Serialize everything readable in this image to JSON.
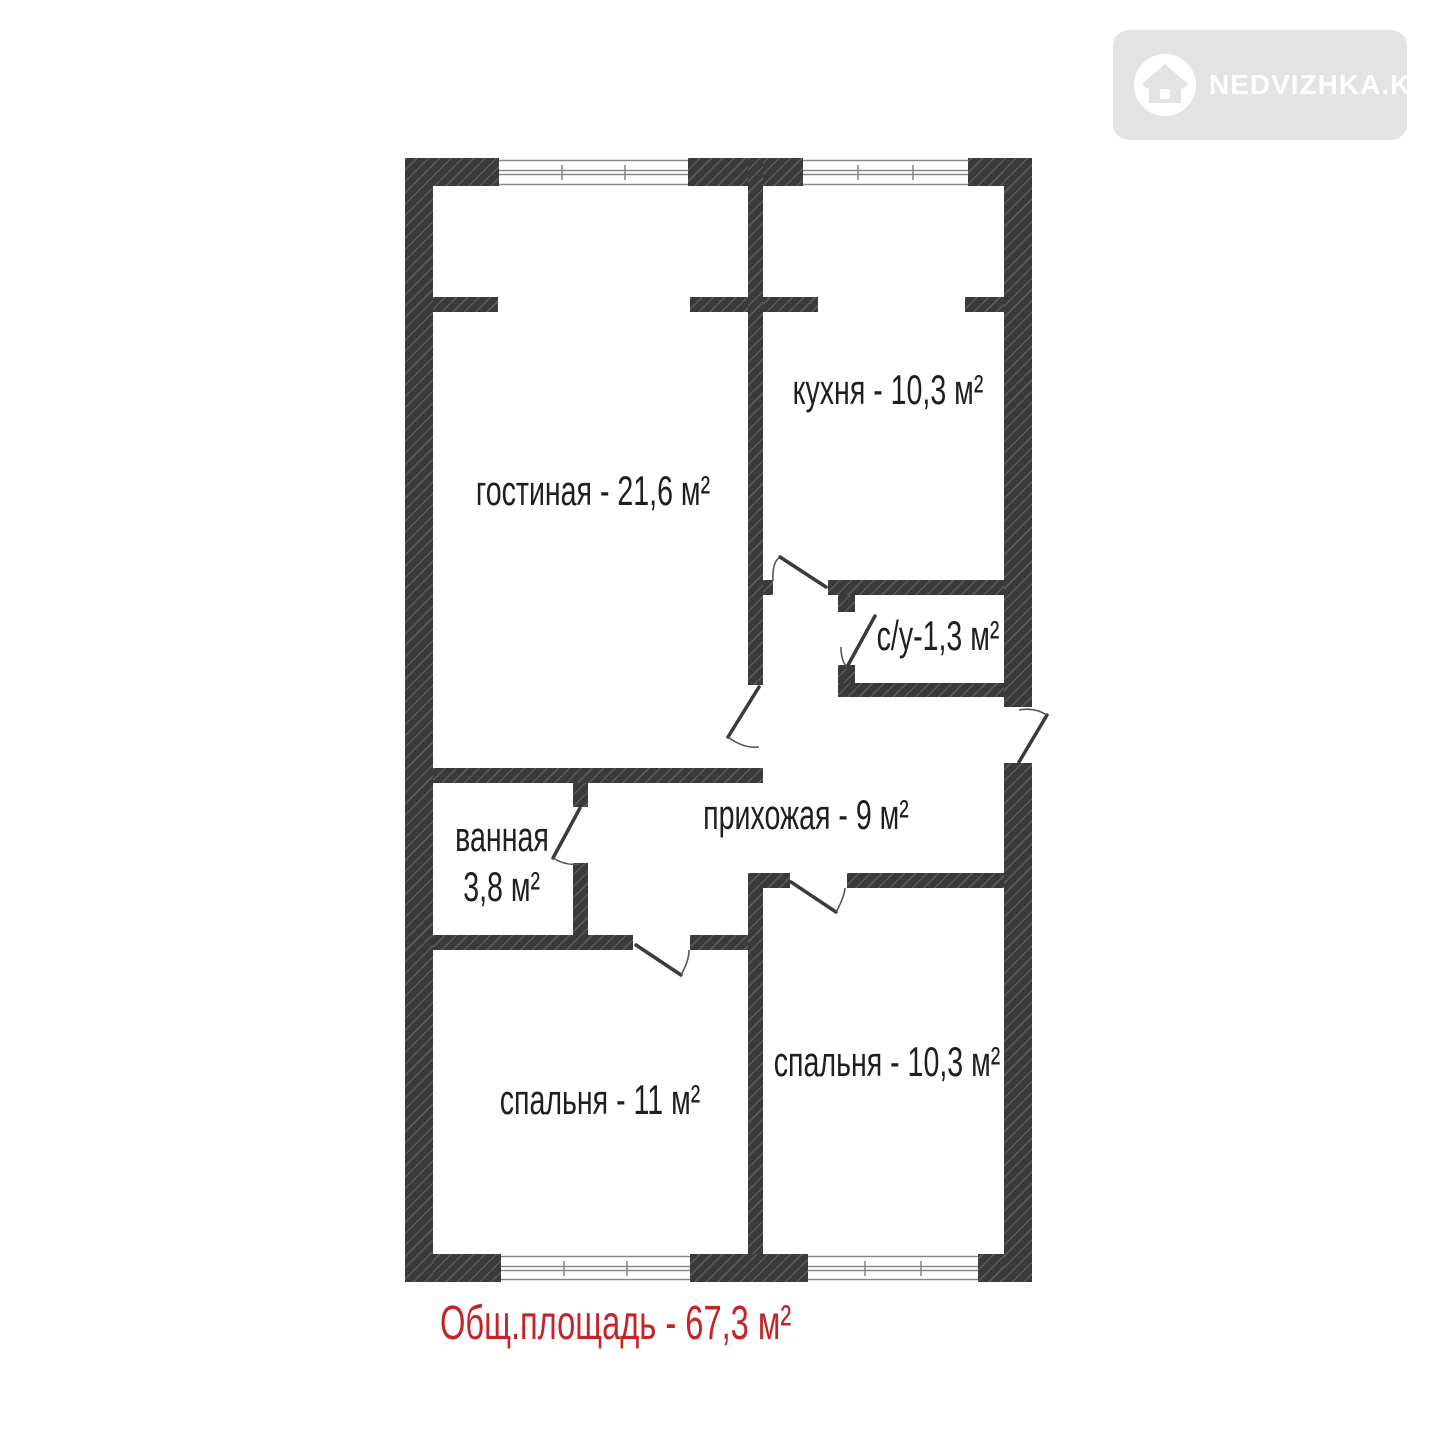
{
  "watermark": {
    "brand": "NEDVIZHKA.KZ",
    "icon": "house-icon"
  },
  "floor_plan": {
    "rooms": {
      "living_room": {
        "label": "гостиная - 21,6 м²"
      },
      "kitchen": {
        "label": "кухня - 10,3 м²"
      },
      "toilet": {
        "label": "с/у-1,3 м²"
      },
      "hallway": {
        "label": "прихожая - 9 м²"
      },
      "bathroom": {
        "name": "ванная",
        "area": "3,8 м²"
      },
      "bedroom_1": {
        "label": "спальня - 11 м²"
      },
      "bedroom_2": {
        "label": "спальня - 10,3 м²"
      }
    },
    "total_area": {
      "label": "Общ.площадь - 67,3 м²"
    }
  },
  "colors": {
    "wall": "#3a3a3a",
    "accent_red": "#c2242a",
    "logo_bg": "#e3e3e3",
    "text": "#1f1f1f"
  }
}
